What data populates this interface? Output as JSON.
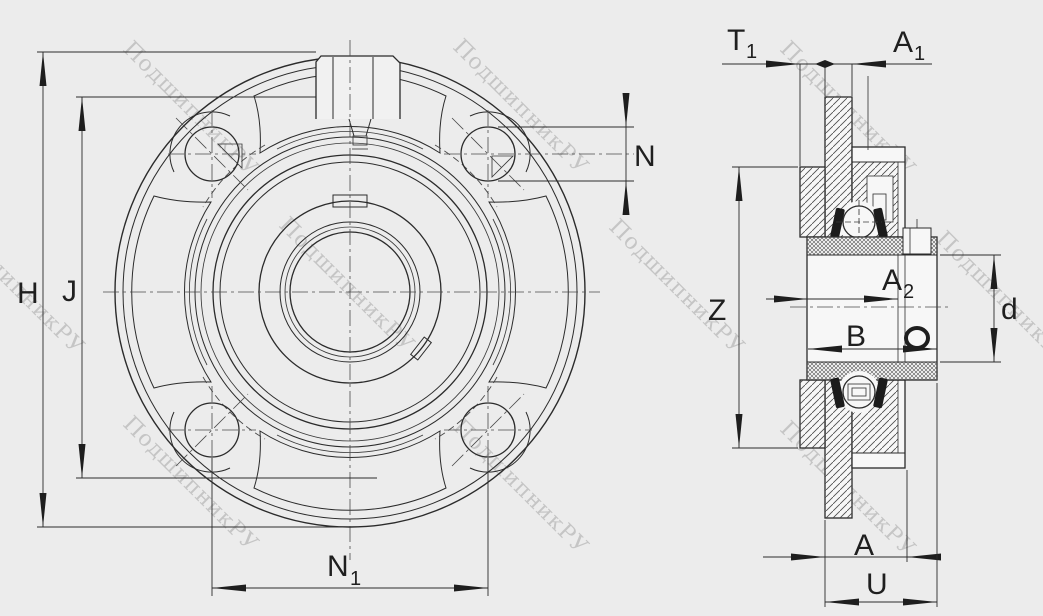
{
  "drawing": {
    "type": "bearing-unit-technical-drawing",
    "views": {
      "front": "front-view",
      "side": "section-side-view"
    }
  },
  "colors": {
    "background": "#ececec",
    "line": "#2b2b2b",
    "watermark": "#a0a0a0"
  },
  "watermark": {
    "text": "ПодшипникРУ"
  },
  "front_view": {
    "labels": {
      "H": "H",
      "J": "J",
      "N": "N",
      "N1": {
        "base": "N",
        "sub": "1"
      }
    }
  },
  "side_view": {
    "labels": {
      "T1": {
        "base": "T",
        "sub": "1"
      },
      "A1": {
        "base": "A",
        "sub": "1"
      },
      "Z": "Z",
      "A2": {
        "base": "A",
        "sub": "2"
      },
      "B": "B",
      "d": "d",
      "A": "A",
      "U": "U"
    }
  }
}
